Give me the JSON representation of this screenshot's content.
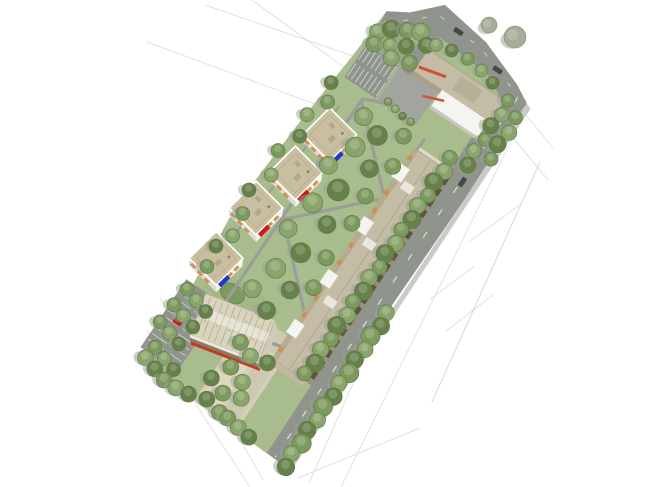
{
  "meta": {
    "title": "Aerial 3D architectural site-plan rendering of an elongated urban block on a white background",
    "view": "axonometric bird's-eye view, site rotated diagonally, surrounding streets drawn as faint pencil lines",
    "visible_text": "none"
  },
  "palette": {
    "background": "#ffffff",
    "road": "#8f948c",
    "sidewalk": "#c9ccc6",
    "green": "#a9bc8e",
    "green_bright": "#a3b884",
    "green_verge": "#98ab7c",
    "plaza": "#d7d1b9",
    "path": "#999e96",
    "roof_tan": "#c4bca4",
    "roof_block": "#c9bfa0",
    "wall_white": "#f4f4f1",
    "facade_brown": "#9b9179",
    "window_orange": "#d4863f",
    "accent_red": "#cc1a1a",
    "accent_blue": "#2038c8",
    "stripe_red": "#d0523a",
    "gym_roof": "#dad4bf",
    "gym_rib": "#b9b29a",
    "gym_red": "#c23b28",
    "gym_brown": "#8a7a5e",
    "tree_green": "#7d9a5e",
    "tree_green_alt": "#8aa56b",
    "tree_green_dark": "#66814a",
    "tree_shadow": "#97a195",
    "tree_gray": "#a4ad97",
    "tree_gray_dark": "#87936f",
    "car_dark": "#444843",
    "sketch_line": "#e0e1df"
  },
  "scene": {
    "site": {
      "shape": "elongated parallelogram city block",
      "orientation": "long axis runs from upper-right to lower-left",
      "context": "faint sketched street and parcel lines outside the block"
    },
    "buildings": [
      {
        "id": "school",
        "label": "large L-shaped building, north-east corner",
        "roof": "tan flat roof with rooftop volume",
        "accents": [
          "red stripe on roof edge",
          "white lower wing"
        ]
      },
      {
        "id": "linear_building",
        "label": "long slab building along the east road",
        "roof": "tan",
        "facade": "brown with dark window bays toward the road",
        "details": "white stair boxes toward the courtyard"
      },
      {
        "id": "block_1",
        "label": "apartment cube (northernmost of four)",
        "accent_panel": "blue"
      },
      {
        "id": "block_2",
        "label": "apartment cube",
        "accent_panel": "red"
      },
      {
        "id": "block_3",
        "label": "apartment cube",
        "accent_panel": "red"
      },
      {
        "id": "block_4",
        "label": "apartment cube (southernmost of four)",
        "accent_panel": "blue"
      },
      {
        "id": "sports_hall",
        "label": "sports hall with ribbed barrel roof, south-west",
        "accents": [
          "red stripe along lower facade",
          "brown band"
        ]
      }
    ],
    "landscape": {
      "courtyard": "central lawn with diagonal grey footpaths and scattered trees",
      "tree_rows": [
        "double roadside row along east edge",
        "boundary row along south-west edge",
        "verge cluster at north-west",
        "trees between parking stalls"
      ],
      "isolated_trees_top_right": 2,
      "parking_lots": 2,
      "plaza_terraces": "light beige terraces at the south end",
      "sports_field": "small bright green field above the sports hall"
    },
    "vehicles": {
      "dark_cars": 3,
      "red_vehicles": 2
    }
  }
}
